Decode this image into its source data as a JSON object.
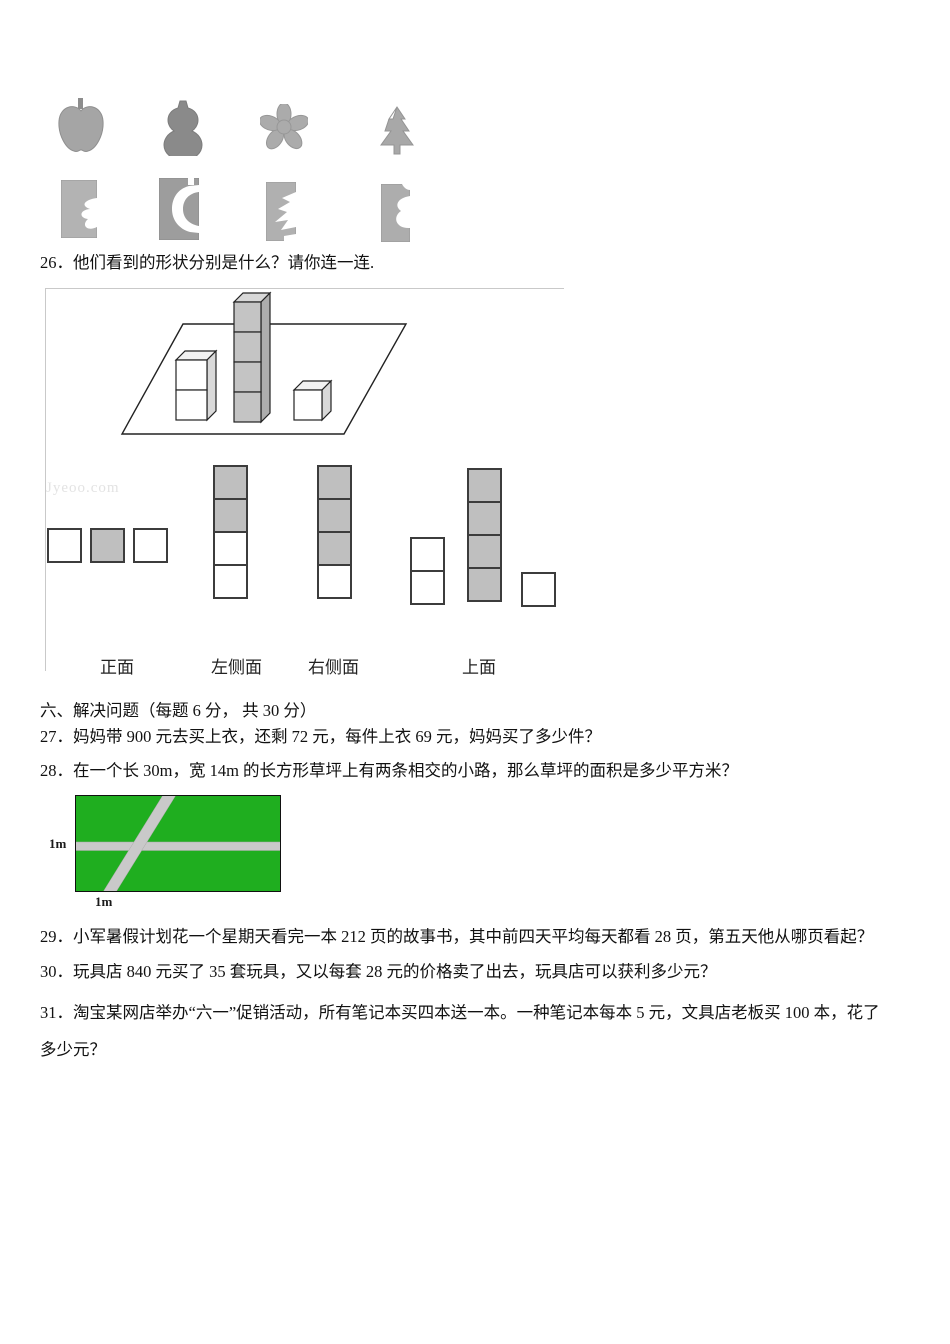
{
  "punch_exercise": {
    "stamps": [
      "apple-stamp",
      "gourd-stamp",
      "flower-stamp",
      "pine-tree-stamp"
    ],
    "cards": [
      "card-with-flower-cutout",
      "card-with-gourd-cutout",
      "card-with-tree-cutout",
      "card-with-apple-cutout"
    ]
  },
  "q26": {
    "text": "26．他们看到的形状分别是什么？请你连一连.",
    "watermark": "Jyeoo.com",
    "view_labels": [
      "正面",
      "左侧面",
      "右侧面",
      "上面"
    ],
    "views": {
      "front": [
        "white",
        "gray",
        "white"
      ],
      "left": [
        "gray",
        "gray",
        "white",
        "white"
      ],
      "right": [
        "gray",
        "gray",
        "gray",
        "white"
      ],
      "top_col_a": [
        "white",
        "white"
      ],
      "top_col_b": [
        "gray",
        "gray",
        "gray",
        "gray"
      ],
      "top_single": [
        "white"
      ]
    },
    "cube_stacks": {
      "left_stack": {
        "count": 2,
        "color": "white"
      },
      "middle_stack": {
        "count": 4,
        "color": "gray"
      },
      "right_stack": {
        "count": 1,
        "color": "white"
      }
    }
  },
  "section6": {
    "title": "六、解决问题（每题 6 分， 共 30 分）"
  },
  "questions": {
    "q27": "27．妈妈带 900 元去买上衣，还剩 72 元，每件上衣 69 元，妈妈买了多少件？",
    "q28": "28．在一个长 30m，宽 14m 的长方形草坪上有两条相交的小路，那么草坪的面积是多少平方米？",
    "q29": "29．小军暑假计划花一个星期天看完一本 212 页的故事书，其中前四天平均每天都看 28 页，第五天他从哪页看起？",
    "q30": "30．玩具店 840 元买了 35 套玩具，又以每套 28 元的价格卖了出去，玩具店可以获利多少元？",
    "q31": "31．淘宝某网店举办“六一”促销活动，所有笔记本买四本送一本。一种笔记本每本 5 元，文具店老板买 100 本，花了多少元？"
  },
  "q28_figure": {
    "left_path_width_label": "1m",
    "bottom_path_width_label": "1m",
    "colors": {
      "grass": "#1fae1f",
      "path": "#c9c9c9",
      "border": "#111111"
    }
  },
  "colors": {
    "square_gray": "#bfbfbf",
    "cube_gray_front": "#c4c4c4",
    "stamp_gray": "#a9a9a9",
    "text": "#111111"
  }
}
